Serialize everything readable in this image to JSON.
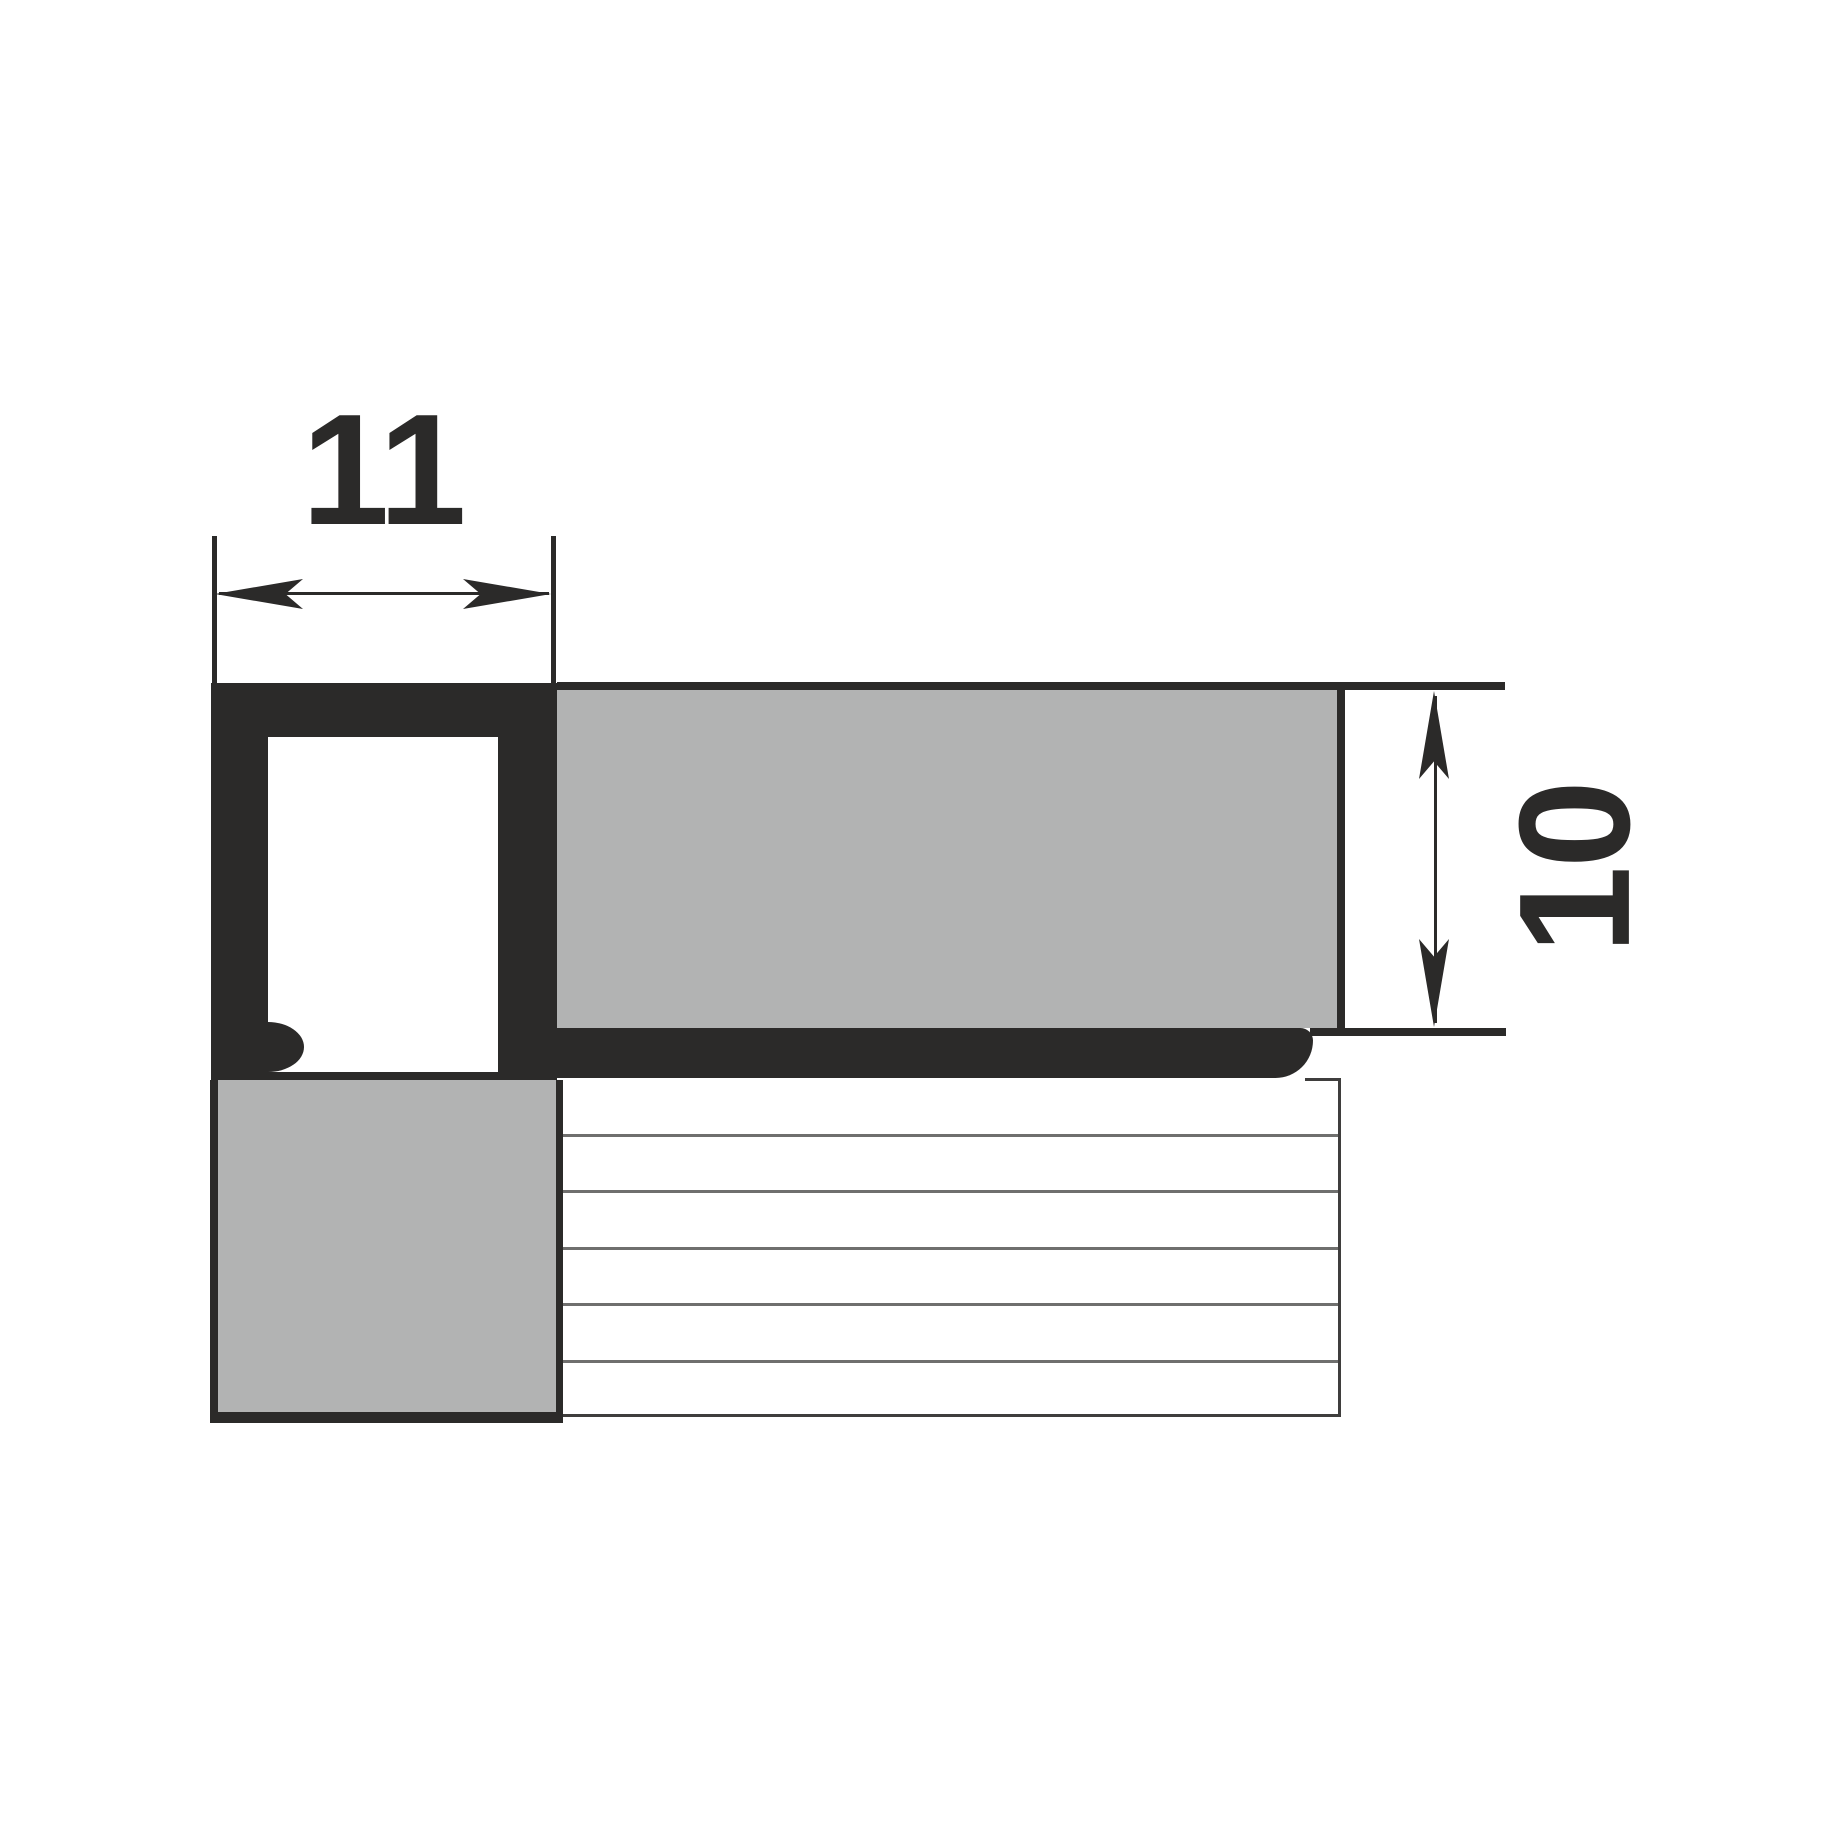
{
  "diagram": {
    "type": "technical-cross-section",
    "subject": "square tile edge trim profile with tiles and adhesive layers",
    "dimensions": {
      "width_label": "11",
      "height_label": "10"
    },
    "colors": {
      "ink": "#2b2a29",
      "tile_gray": "#b2b3b3",
      "hatch_line_gray": "#6f6f6e",
      "background": "#ffffff"
    }
  }
}
